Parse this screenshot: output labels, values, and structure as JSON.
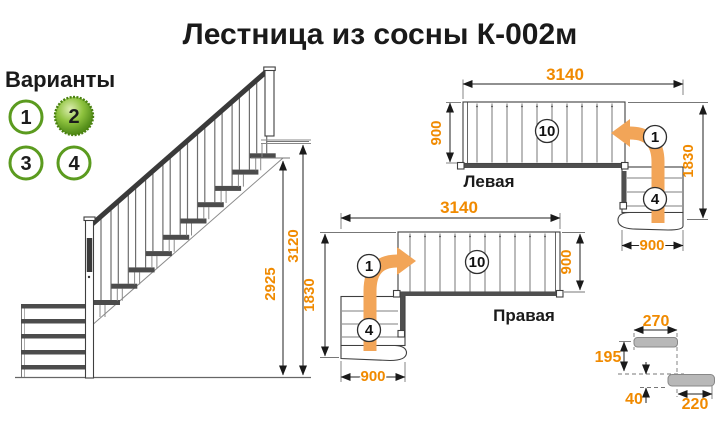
{
  "title": "Лестница из сосны К-002м",
  "variants": {
    "label": "Варианты",
    "options": [
      {
        "value": "1",
        "selected": false
      },
      {
        "value": "2",
        "selected": true
      },
      {
        "value": "3",
        "selected": false
      },
      {
        "value": "4",
        "selected": false
      }
    ]
  },
  "side_view": {
    "total_height": "3120",
    "stair_height": "2925"
  },
  "plan_left": {
    "label": "Левая",
    "length": "3140",
    "flight_width": "900",
    "total_depth": "1830",
    "lower_flight_width": "900",
    "main_steps": "10",
    "first_step": "1",
    "lower_steps": "4"
  },
  "plan_right": {
    "label": "Правая",
    "length": "3140",
    "flight_width": "900",
    "total_depth": "1830",
    "lower_flight_width": "900",
    "main_steps": "10",
    "first_step": "1",
    "lower_steps": "4"
  },
  "step_detail": {
    "tread_depth": "270",
    "step_rise": "195",
    "tread_thickness": "40",
    "tread_run": "220"
  },
  "colors": {
    "dimension_orange": "#F08A00",
    "arrow_orange": "#F2A558",
    "variant_green": "#5B9B1F",
    "variant_green_dark": "#49810F",
    "drawing_dark": "#4C4C4C",
    "text_black": "#1A1A1A"
  }
}
